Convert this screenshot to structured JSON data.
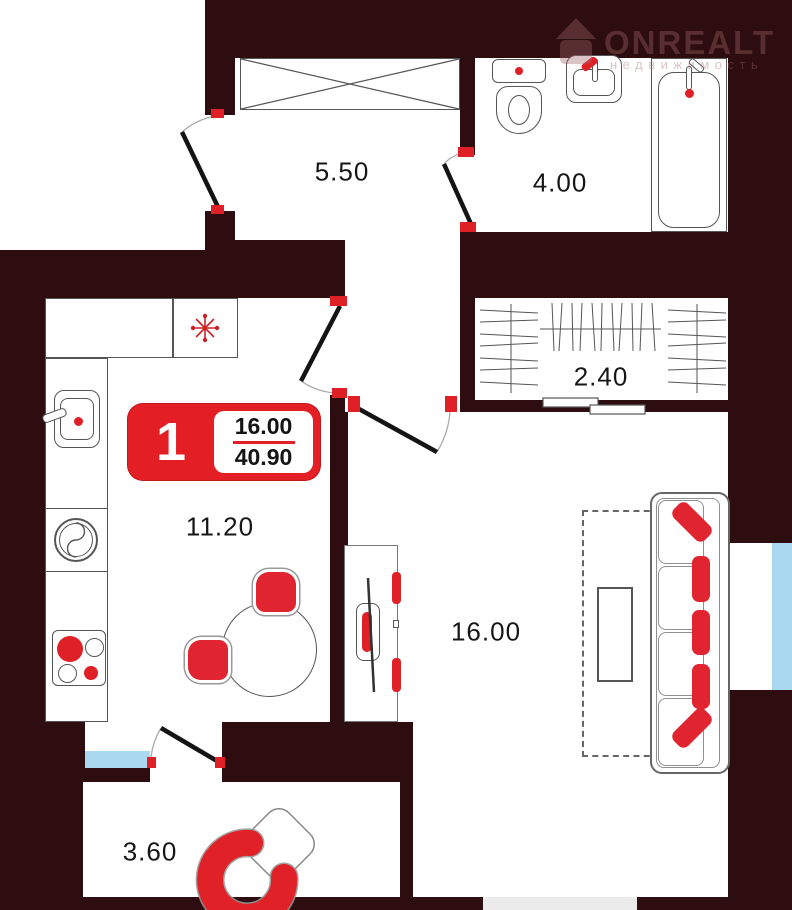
{
  "watermark": {
    "brand": "ONREALT",
    "tagline": "недвижимость"
  },
  "badge": {
    "rooms": "1",
    "living_area": "16.00",
    "total_area": "40.90"
  },
  "rooms": {
    "hallway": {
      "area": "5.50"
    },
    "bathroom": {
      "area": "4.00"
    },
    "wardrobe": {
      "area": "2.40"
    },
    "kitchen": {
      "area": "11.20"
    },
    "living": {
      "area": "16.00"
    },
    "balcony": {
      "area": "3.60"
    }
  },
  "colors": {
    "wall": "#2e0d10",
    "accent": "#e31e24",
    "window_glass": "#a9d9ef",
    "line": "#555555"
  }
}
